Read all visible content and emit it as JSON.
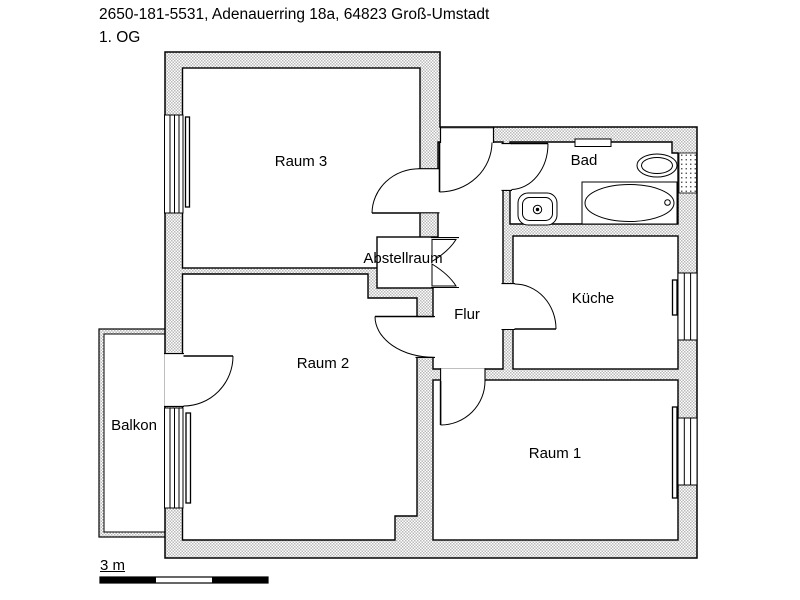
{
  "header": {
    "title": "2650-181-5531, Adenauerring 18a, 64823 Groß-Umstadt",
    "floor": "1. OG"
  },
  "rooms": {
    "raum3": "Raum 3",
    "bad": "Bad",
    "abstellraum": "Abstellraum",
    "flur": "Flur",
    "kueche": "Küche",
    "raum2": "Raum 2",
    "balkon": "Balkon",
    "raum1": "Raum 1"
  },
  "scale": {
    "label": "3 m",
    "length_m": 3
  },
  "colors": {
    "wall_fill": "#c0c0c0",
    "outline": "#000000",
    "background": "#ffffff"
  },
  "fixtures": {
    "bathtub": "bathtub",
    "washbasin": "washbasin",
    "shower": "shower",
    "wall_vent": "wall-vent"
  },
  "legend": {
    "doors": [
      "entrance-door",
      "raum3-door",
      "bad-door",
      "kueche-door",
      "raum2-door",
      "raum1-door",
      "balkon-door",
      "abstellraum-folding-door"
    ],
    "windows": [
      "raum3-window",
      "raum2-window",
      "kueche-window",
      "raum1-window",
      "bad-window"
    ]
  }
}
